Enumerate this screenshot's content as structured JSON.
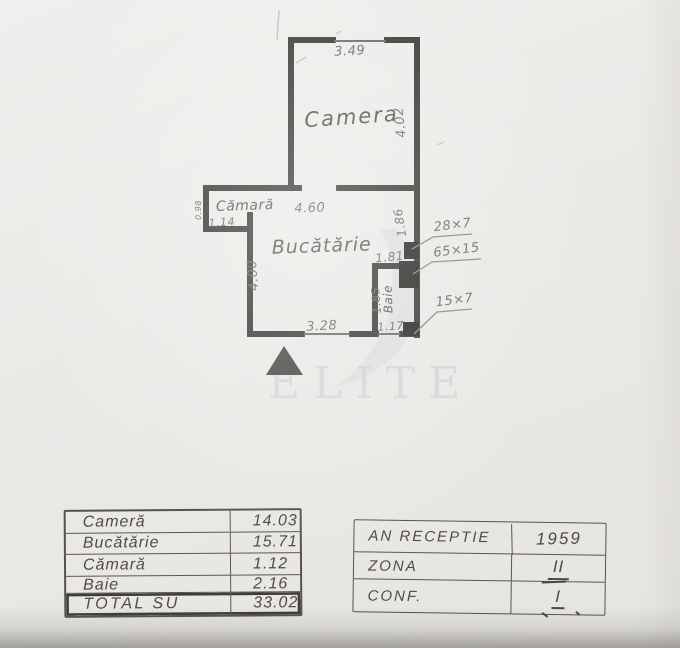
{
  "watermark": {
    "text": "ELITE"
  },
  "colors": {
    "wall": "#3d3b38",
    "duct": "#2c2a27",
    "pencil": "#6f6c66",
    "room_name": "#595650",
    "leader": "#8d8a84",
    "watermark": "#ccd0d6",
    "mark": "#b9b6b0"
  },
  "plan": {
    "walls": [
      [
        288,
        37,
        48,
        6
      ],
      [
        384,
        37,
        36,
        6
      ],
      [
        288,
        37,
        6,
        153
      ],
      [
        414,
        37,
        6,
        301
      ],
      [
        288,
        185,
        14,
        6
      ],
      [
        336,
        185,
        84,
        6
      ],
      [
        203,
        185,
        91,
        6
      ],
      [
        203,
        185,
        6,
        47
      ],
      [
        203,
        226,
        50,
        6
      ],
      [
        247,
        212,
        6,
        20
      ],
      [
        247,
        226,
        6,
        111
      ],
      [
        247,
        331,
        58,
        6
      ],
      [
        349,
        331,
        30,
        6
      ],
      [
        399,
        331,
        21,
        6
      ],
      [
        372,
        263,
        6,
        74
      ],
      [
        372,
        263,
        32,
        6
      ]
    ],
    "windows": [
      [
        334,
        41,
        386,
        41
      ],
      [
        304,
        334,
        350,
        334
      ],
      [
        378,
        334,
        400,
        334
      ]
    ],
    "ducts": [
      [
        404,
        242,
        15,
        17
      ],
      [
        399,
        261,
        20,
        27
      ],
      [
        403,
        322,
        16,
        14
      ]
    ],
    "leaders": [
      "472,234 433,237 412,249",
      "481,259 432,262 413,274",
      "472,309 437,312 414,334"
    ],
    "marks": [
      [
        296,
        63,
        306,
        57
      ],
      [
        437,
        145,
        444,
        142
      ],
      [
        279,
        10,
        277,
        40
      ],
      [
        336,
        34,
        341,
        31
      ]
    ],
    "north_triangle": "266,375 303,375 284,346",
    "swoosh": "M396,228 C424,266 430,306 402,346 C388,366 362,381 336,387 C368,362 388,334 392,296 C395,264 390,244 380,230 Z",
    "labels": [
      {
        "id": "camera-width",
        "text": "3.49",
        "x": 350,
        "y": 55,
        "size": 13,
        "rot": -3
      },
      {
        "id": "camera-name",
        "text": "Camera",
        "x": 352,
        "y": 124,
        "size": 21,
        "rot": -4,
        "ls": 2,
        "name": true
      },
      {
        "id": "camera-depth",
        "text": "4.02",
        "x": 404,
        "y": 122,
        "size": 13,
        "rot": -96
      },
      {
        "id": "camara-name",
        "text": "Cămară",
        "x": 245,
        "y": 210,
        "size": 14,
        "rot": -2,
        "name": true
      },
      {
        "id": "camara-depth",
        "text": "0.98",
        "x": 201,
        "y": 210,
        "size": 8,
        "rot": -90
      },
      {
        "id": "camara-width",
        "text": "1.14",
        "x": 222,
        "y": 226,
        "size": 11,
        "rot": -4
      },
      {
        "id": "kitchen-width",
        "text": "4.60",
        "x": 310,
        "y": 212,
        "size": 13,
        "rot": -2
      },
      {
        "id": "kitchen-name",
        "text": "Bucătărie",
        "x": 322,
        "y": 252,
        "size": 19,
        "rot": -2,
        "ls": 1,
        "name": true
      },
      {
        "id": "kitchen-depth",
        "text": "4.00",
        "x": 257,
        "y": 275,
        "size": 13,
        "rot": -94
      },
      {
        "id": "wall-seg",
        "text": "1.86",
        "x": 404,
        "y": 222,
        "size": 12,
        "rot": -99
      },
      {
        "id": "dim-181",
        "text": "1.81",
        "x": 390,
        "y": 261,
        "size": 12,
        "rot": -6
      },
      {
        "id": "baie-depth",
        "text": "1.85",
        "x": 380,
        "y": 300,
        "size": 11,
        "rot": -95
      },
      {
        "id": "baie-name",
        "text": "Baie",
        "x": 392,
        "y": 299,
        "size": 12,
        "rot": -92,
        "name": true
      },
      {
        "id": "kitchen-window-width",
        "text": "3.28",
        "x": 322,
        "y": 330,
        "size": 13,
        "rot": -3
      },
      {
        "id": "baie-width",
        "text": "1.17",
        "x": 391,
        "y": 330,
        "size": 11,
        "rot": -4
      },
      {
        "id": "duct-28x7",
        "text": "28×7",
        "x": 453,
        "y": 229,
        "size": 13,
        "rot": -7
      },
      {
        "id": "duct-65x15",
        "text": "65×15",
        "x": 457,
        "y": 254,
        "size": 13,
        "rot": -7
      },
      {
        "id": "duct-15x7",
        "text": "15×7",
        "x": 455,
        "y": 304,
        "size": 13,
        "rot": -7
      }
    ]
  },
  "tables": {
    "areas": {
      "rows": [
        {
          "label": "Cameră",
          "value": "14.03"
        },
        {
          "label": "Bucătărie",
          "value": "15.71"
        },
        {
          "label": "Cămară",
          "value": "1.12"
        },
        {
          "label": "Baie",
          "value": "2.16"
        },
        {
          "label": "TOTAL SU",
          "value": "33.02"
        }
      ]
    },
    "info": {
      "rows": [
        {
          "label": "AN RECEPTIE",
          "value": "1959"
        },
        {
          "label": "ZONA",
          "value": "II"
        },
        {
          "label": "CONF.",
          "value": "I"
        }
      ]
    }
  }
}
